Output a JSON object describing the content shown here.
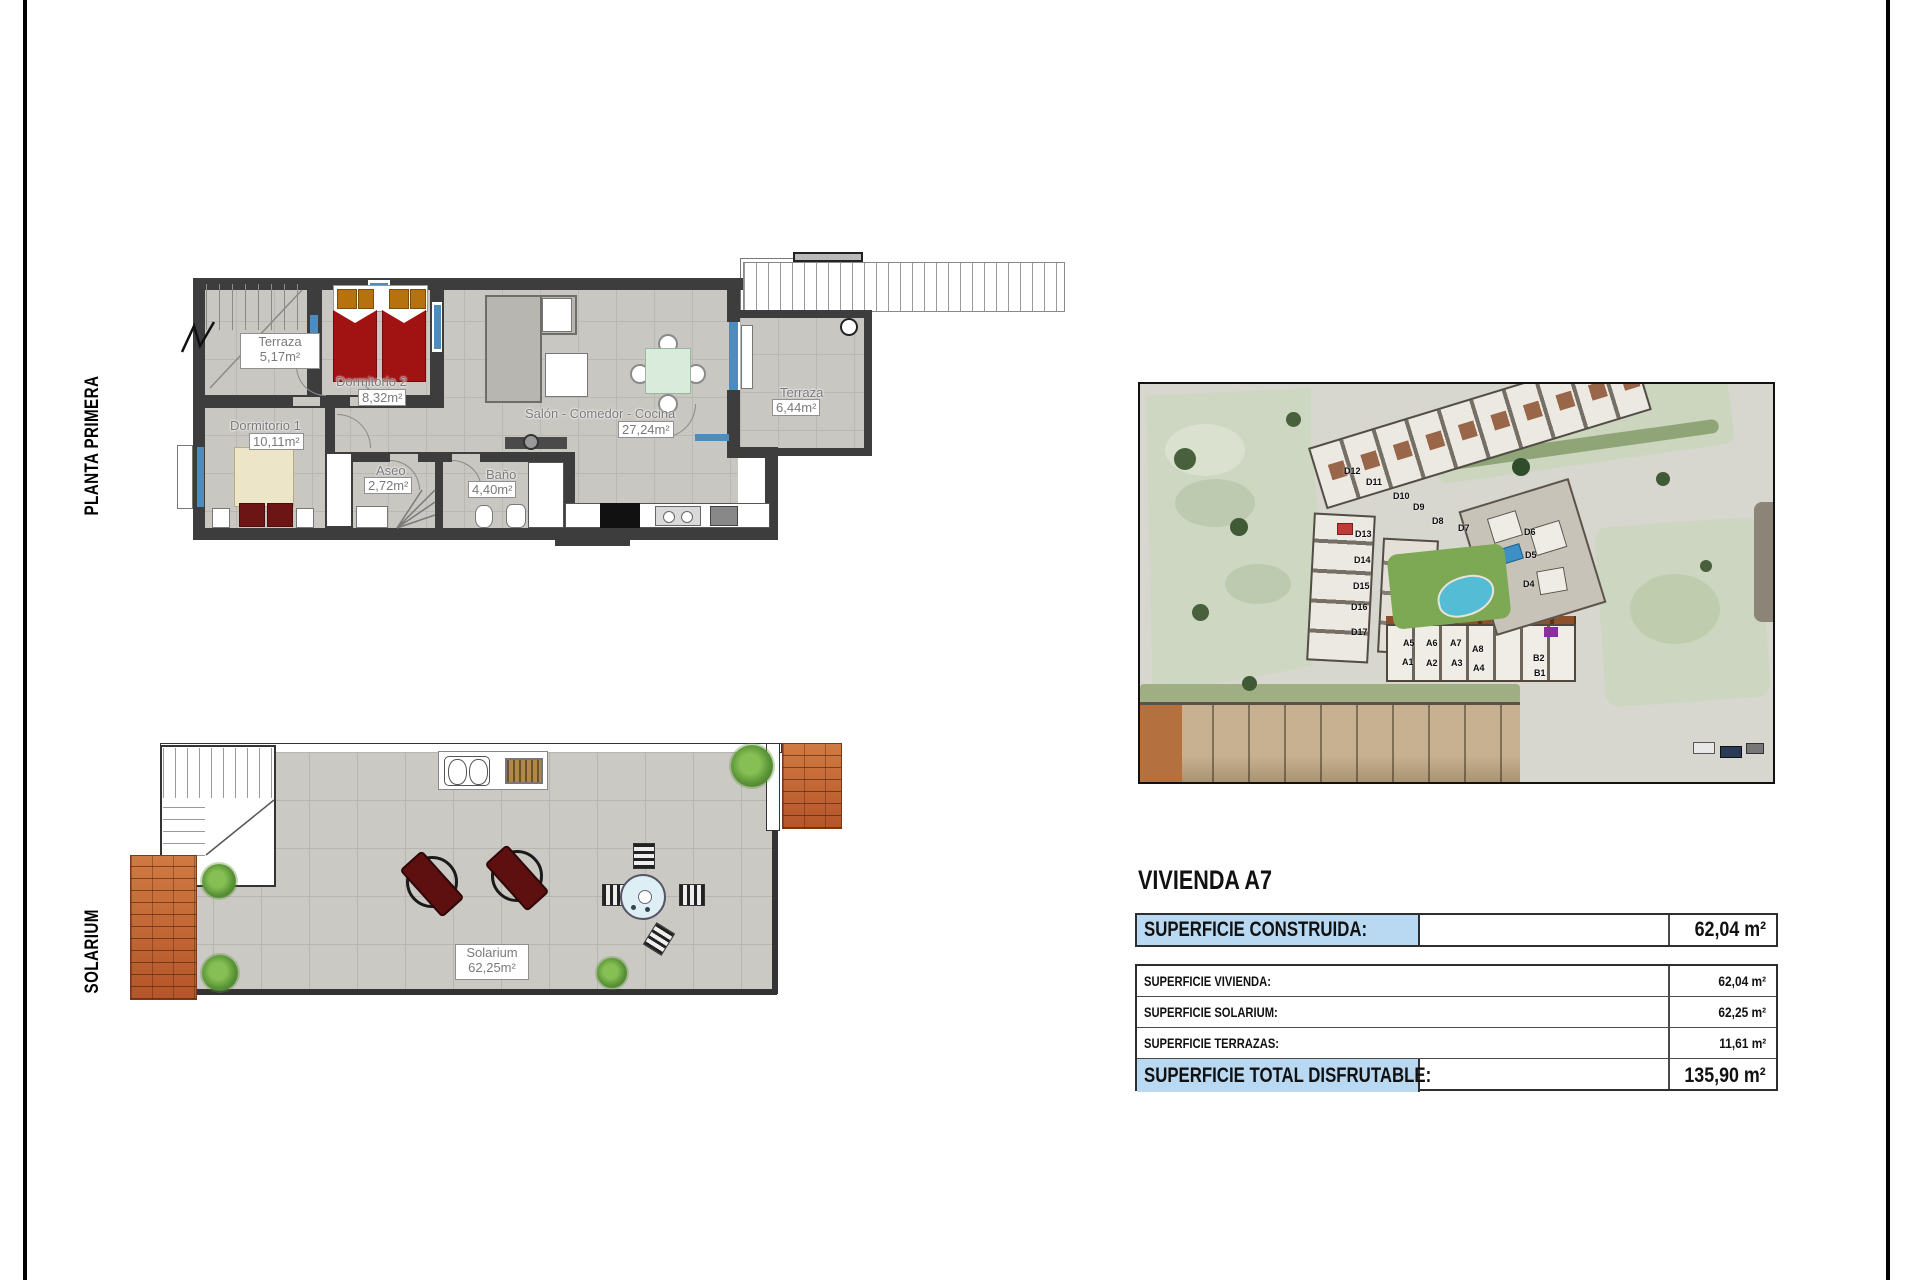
{
  "plans": {
    "planta_primera": {
      "side_label": "PLANTA PRIMERA",
      "rooms": [
        {
          "name": "Terraza",
          "area": "5,17m²"
        },
        {
          "name": "Dormitorio 2",
          "area": "8,32m²"
        },
        {
          "name": "Dormitorio 1",
          "area": "10,11m²"
        },
        {
          "name": "Aseo",
          "area": "2,72m²"
        },
        {
          "name": "Baño",
          "area": "4,40m²"
        },
        {
          "name": "Salón - Comedor - Cocina",
          "area": "27,24m²"
        },
        {
          "name": "Terraza",
          "area": "6,44m²"
        }
      ]
    },
    "solarium": {
      "side_label": "SOLARIUM",
      "rooms": [
        {
          "name": "Solarium",
          "area": "62,25m²"
        }
      ]
    }
  },
  "map": {
    "unit_labels": [
      "D12",
      "D11",
      "D10",
      "D9",
      "D8",
      "D7",
      "D13",
      "D14",
      "D15",
      "D16",
      "D17",
      "D6",
      "D5",
      "D4",
      "A5",
      "A6",
      "A7",
      "A8",
      "A1",
      "A2",
      "A3",
      "A4",
      "B2",
      "B1"
    ]
  },
  "info": {
    "title": "VIVIENDA A7",
    "summary_row": {
      "label": "SUPERFICIE CONSTRUIDA:",
      "value": "62,04 m²"
    },
    "rows": [
      {
        "label": "SUPERFICIE VIVIENDA:",
        "value": "62,04 m²"
      },
      {
        "label": "SUPERFICIE SOLARIUM:",
        "value": "62,25 m²"
      },
      {
        "label": "SUPERFICIE TERRAZAS:",
        "value": "11,61 m²"
      },
      {
        "label": "SUPERFICIE TOTAL DISFRUTABLE:",
        "value": "135,90 m²"
      }
    ],
    "highlight_color": "#b9d9f2"
  }
}
